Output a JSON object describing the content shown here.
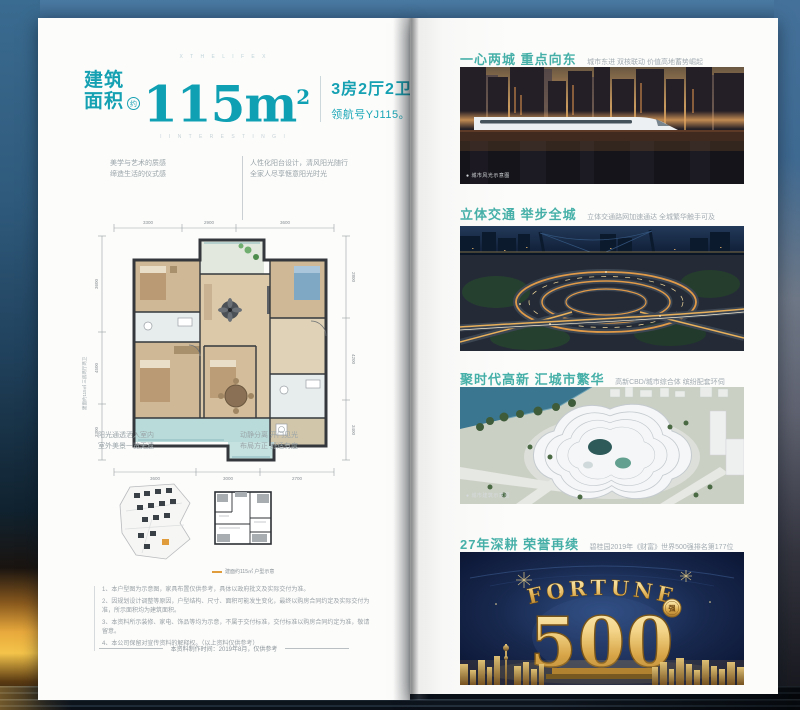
{
  "colors": {
    "accent_teal": "#16a1b3",
    "section_teal": "#46b0a8",
    "gold": "#e0b050",
    "highlight_orange": "#e09b3a"
  },
  "page": {
    "left": {
      "deco_top": "X  T H E  L I F E  X",
      "deco_mid": "I  I N T E R E S T I N G  I",
      "header": {
        "label_top": "建筑",
        "label_bottom": "面积",
        "approx": "约",
        "area": "115m",
        "area_sup": "2",
        "spec": "3房2厅2卫",
        "model": "领航号YJ115。"
      },
      "callouts": {
        "top_left_1": "美学与艺术的质感",
        "top_left_2": "缔造生活的仪式感",
        "top_right_1": "人性化阳台设计，清风阳光随行",
        "top_right_2": "全家人尽享惬意阳光时光",
        "bottom_left_1": "阳光通透洒入室内",
        "bottom_left_2": "室外美景一览无遗",
        "bottom_right_1": "动静分离 开门见光",
        "bottom_right_2": "布局方正 舒适有度"
      },
      "plan": {
        "side_note": "建面约115㎡ 三房两厅两卫",
        "dims_top": [
          "3300",
          "2900",
          "3600"
        ],
        "dims_bottom": [
          "3600",
          "3000",
          "2700"
        ],
        "dims_left": [
          "3600",
          "4500",
          "3300"
        ],
        "dims_right": [
          "2800",
          "4200",
          "3400"
        ]
      },
      "keyplan_caption": "建面约115㎡ 户型示意",
      "disclaimers": [
        "1、本户型图为示意图，家具布置仅供参考，具体以政府批文及实际交付为准。",
        "2、因规划设计调整等原因，户型结构、尺寸、面积可能发生变化，最终以购房合同约定及实际交付为准，所示面积均为建筑面积。",
        "3、本资料所示装修、家电、饰品等均为示意，不属于交付标准，交付标准以购房合同约定为准，敬请留意。",
        "4、本公司保留对宣传资料的解释权。（以上资料仅供参考）"
      ],
      "footer": "本资料制作时间：2019年8月，仅供参考"
    },
    "right": {
      "sections": [
        {
          "title": "一心两城 重点向东",
          "subtitle": "城市东进 双核联动 价值高地蓄势崛起",
          "caption": "● 城市风光示意图"
        },
        {
          "title": "立体交通 举步全城",
          "subtitle": "立体交通路网加速通达 全城繁华触手可及"
        },
        {
          "title": "聚时代高新 汇城市繁华",
          "subtitle": "高新CBD/城市综合体 缤纷配套环伺",
          "caption": "● 城市建筑示意图"
        },
        {
          "title": "27年深耕 荣誉再续",
          "subtitle": "碧桂园2019年《财富》世界500强排名第177位"
        }
      ],
      "fortune": {
        "word": "FORTUNE",
        "number": "500",
        "badge": "强"
      }
    }
  }
}
